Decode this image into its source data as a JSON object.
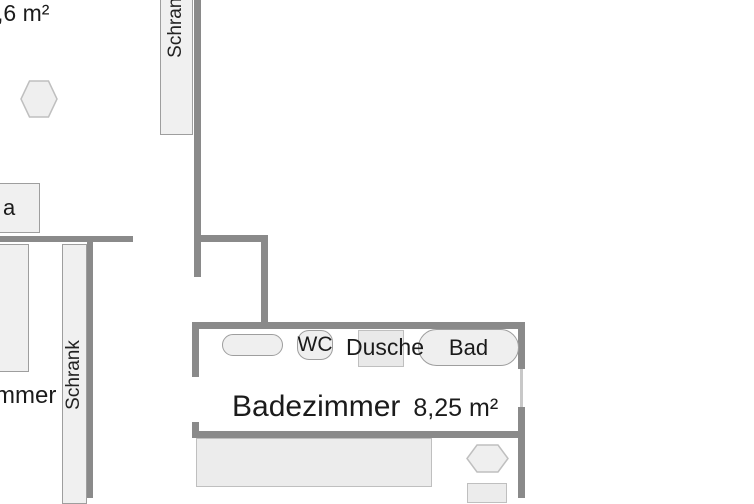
{
  "colors": {
    "background": "#ffffff",
    "wall": "#8a8a8a",
    "door": "#c8c8c8",
    "furniture-fill": "#f0f0f0",
    "fixture-fill": "#efefef",
    "furniture-border": "#9e9e9e",
    "light-border": "#bfbfbf",
    "text": "#1b1b1b"
  },
  "labels": {
    "area_top_left": ",6 m²",
    "closet_top": "Schrank",
    "sofa_partial": "a",
    "room_name_partial": "mmer",
    "wardrobe_left": "Schrank",
    "wc": "WC",
    "shower": "Dusche",
    "bathtub": "Bad",
    "bathroom_name": "Badezimmer",
    "bathroom_area": "8,25 m²"
  }
}
